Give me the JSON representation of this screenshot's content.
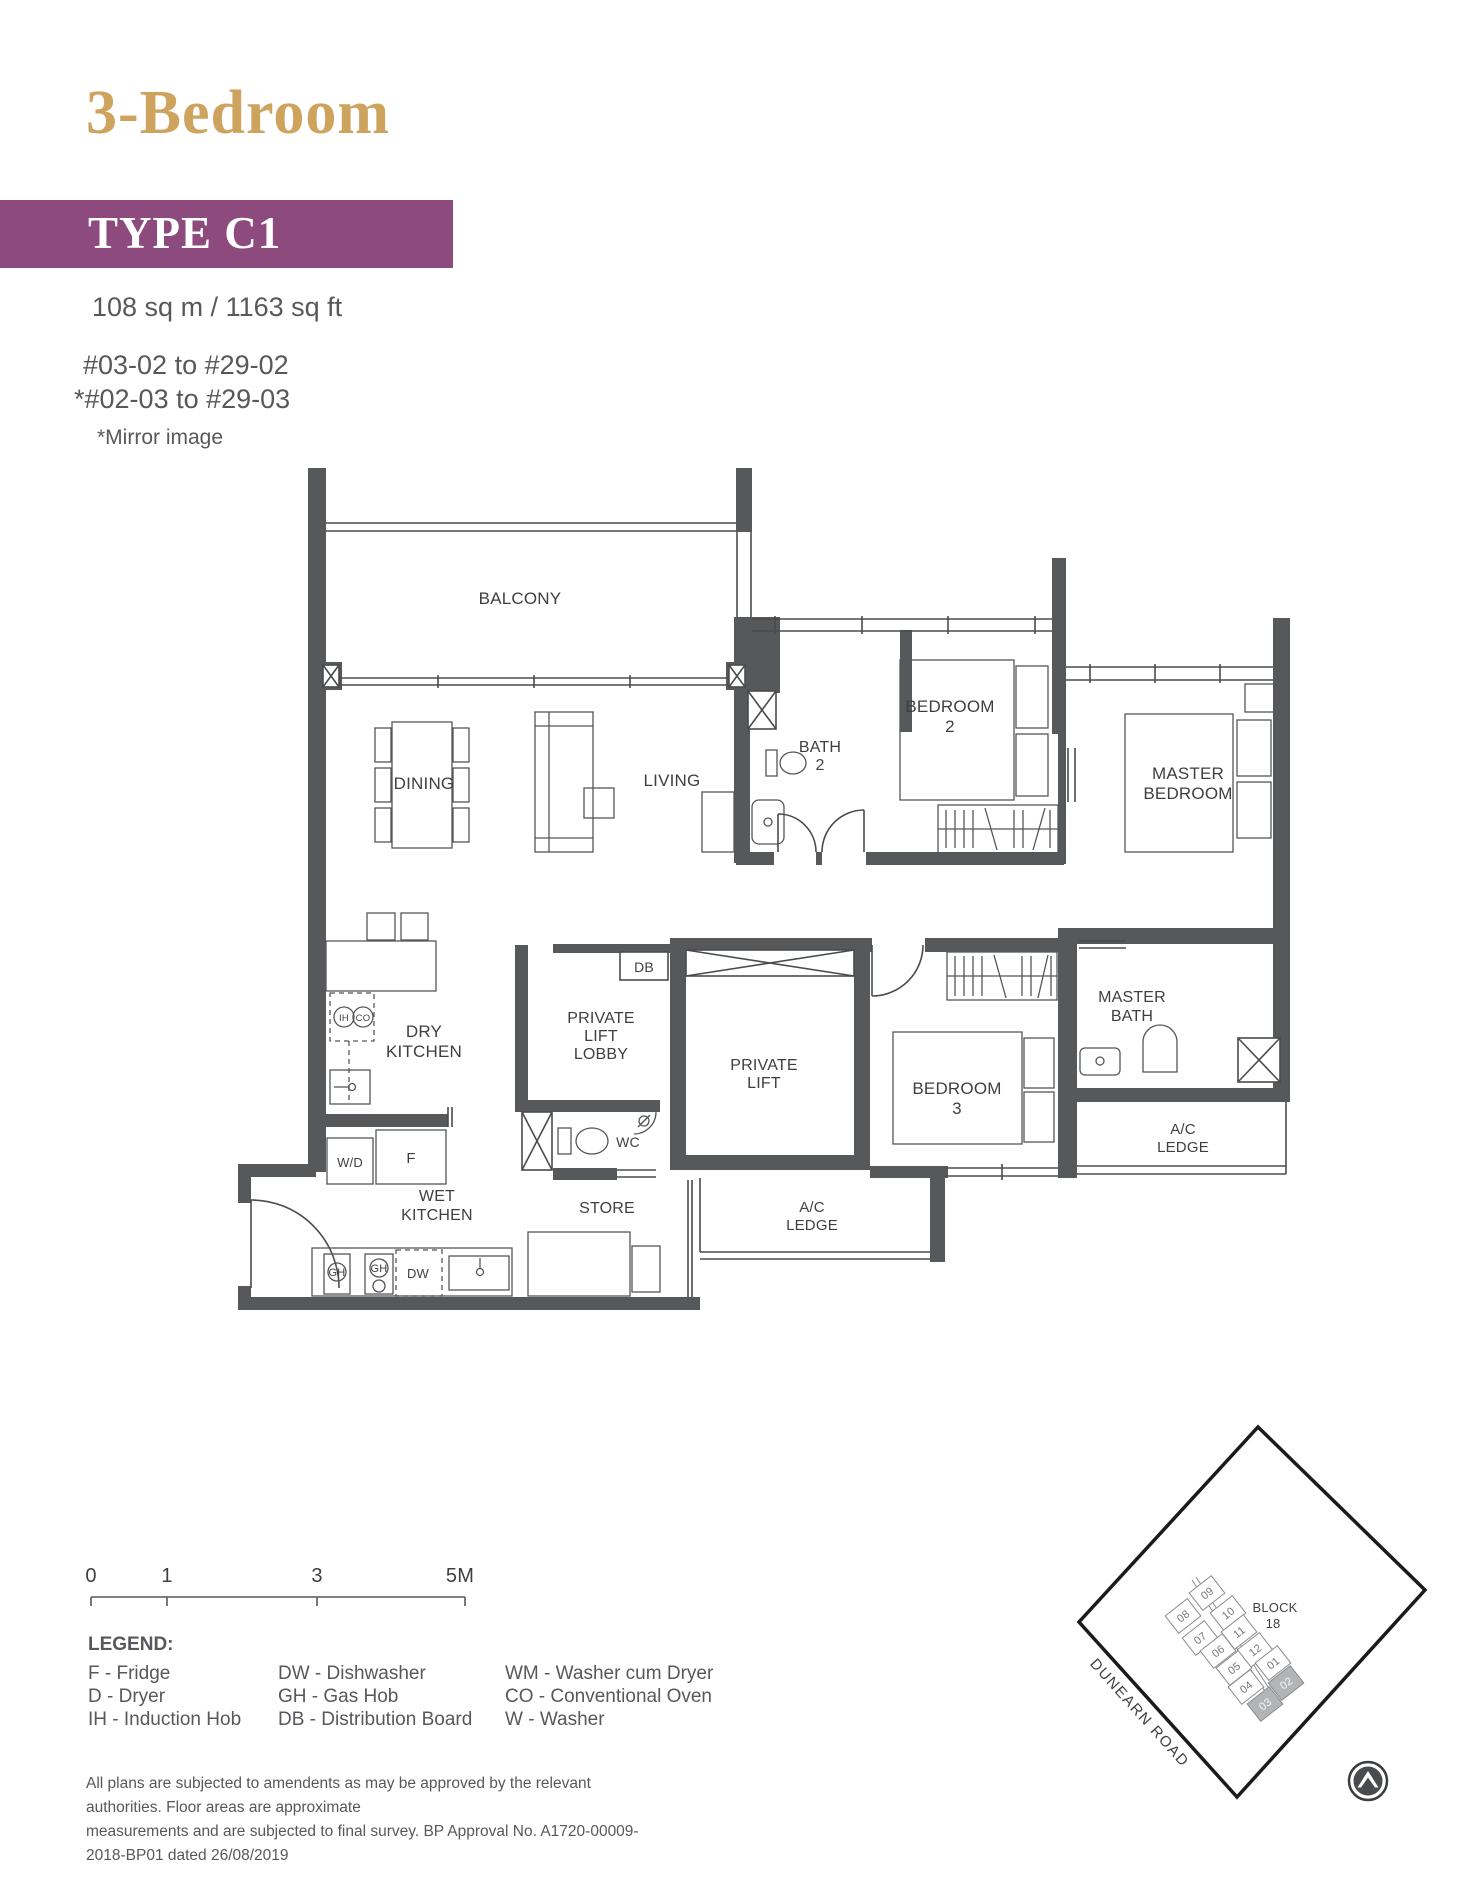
{
  "header": {
    "title": "3-Bedroom",
    "type_label": "TYPE C1",
    "area": "108 sq m / 1163 sq ft",
    "units_line1": "#03-02 to #29-02",
    "units_line2": "*#02-03 to #29-03",
    "mirror_note": "*Mirror image",
    "accent_gold": "#CEA35E",
    "banner_purple": "#8C4A7D",
    "text_grey": "#57585B"
  },
  "floor_plan": {
    "wall_color": "#57585A",
    "labels": {
      "balcony": "BALCONY",
      "dining": "DINING",
      "living": "LIVING",
      "bath2_1": "BATH",
      "bath2_2": "2",
      "bedroom2_1": "BEDROOM",
      "bedroom2_2": "2",
      "master_bed_1": "MASTER",
      "master_bed_2": "BEDROOM",
      "dry_kitchen_1": "DRY",
      "dry_kitchen_2": "KITCHEN",
      "lift_lobby_1": "PRIVATE",
      "lift_lobby_2": "LIFT",
      "lift_lobby_3": "LOBBY",
      "lift_1": "PRIVATE",
      "lift_2": "LIFT",
      "db": "DB",
      "wc": "WC",
      "store": "STORE",
      "wet_kitchen_1": "WET",
      "wet_kitchen_2": "KITCHEN",
      "bedroom3_1": "BEDROOM",
      "bedroom3_2": "3",
      "master_bath_1": "MASTER",
      "master_bath_2": "BATH",
      "ac_1": "A/C",
      "ac_2": "LEDGE",
      "wd": "W/D",
      "f": "F",
      "gh": "GH",
      "dw": "DW",
      "ih": "IH",
      "co": "CO"
    }
  },
  "scale_bar": {
    "t0": "0",
    "t1": "1",
    "t3": "3",
    "t5": "5M"
  },
  "legend": {
    "title": "LEGEND:",
    "col1": [
      "F - Fridge",
      "D - Dryer",
      "IH - Induction Hob"
    ],
    "col2": [
      "DW - Dishwasher",
      "GH - Gas Hob",
      "DB - Distribution Board"
    ],
    "col3": [
      "WM - Washer cum Dryer",
      "CO - Conventional Oven",
      "W - Washer"
    ]
  },
  "site_plan": {
    "block_1": "BLOCK",
    "block_2": "18",
    "road": "DUNEARN ROAD",
    "highlighted": [
      "02",
      "03"
    ],
    "units": {
      "u01": "01",
      "u02": "02",
      "u03": "03",
      "u04": "04",
      "u05": "05",
      "u06": "06",
      "u07": "07",
      "u08": "08",
      "u09": "09",
      "u10": "10",
      "u11": "11",
      "u12": "12"
    }
  },
  "disclaimer_1": "All plans are subjected to amendents as may be approved by the relevant authorities. Floor areas are approximate",
  "disclaimer_2": "measurements and are subjected to final survey. BP Approval No. A1720-00009-2018-BP01 dated 26/08/2019"
}
